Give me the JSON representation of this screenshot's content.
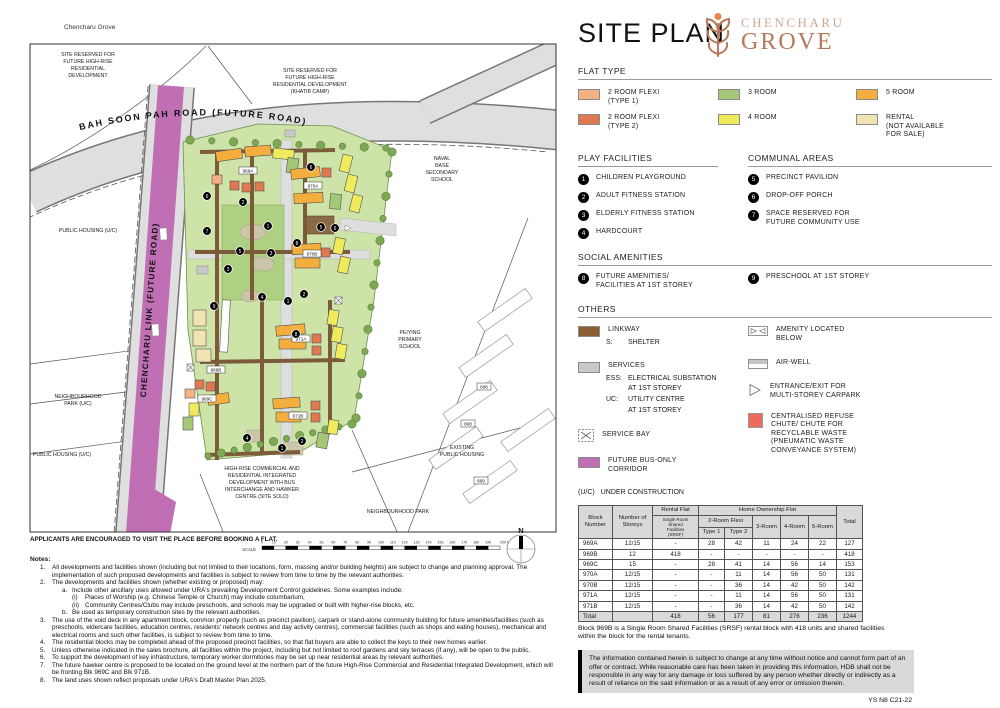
{
  "title": "SITE PLAN",
  "brand": {
    "top": "CHENCHARU",
    "bottom": "GROVE"
  },
  "colors": {
    "t1": "#F4B183",
    "t2": "#E07850",
    "r3": "#A5C878",
    "r4": "#F0EB5C",
    "r5": "#F3AE3E",
    "rental": "#F0E5B2",
    "linkway": "#8A5F34",
    "services": "#C8C8C8",
    "bus": "#C06FB5",
    "refuse": "#EC6A5C",
    "white": "#FFFFFF"
  },
  "legend": {
    "flat_type": {
      "heading": "FLAT TYPE",
      "items": [
        {
          "l1": "2 ROOM FLEXI",
          "l2": "(TYPE 1)"
        },
        {
          "l1": "3 ROOM"
        },
        {
          "l1": "5 ROOM"
        },
        {
          "l1": "2 ROOM FLEXI",
          "l2": "(TYPE 2)"
        },
        {
          "l1": "4 ROOM"
        },
        {
          "l1": "RENTAL",
          "l2": "(NOT AVAILABLE",
          "l3": "FOR SALE)"
        }
      ]
    },
    "play": {
      "heading": "PLAY FACILITIES",
      "items": [
        {
          "n": "1",
          "label": "CHILDREN PLAYGROUND"
        },
        {
          "n": "2",
          "label": "ADULT FITNESS STATION"
        },
        {
          "n": "3",
          "label": "ELDERLY FITNESS STATION"
        },
        {
          "n": "4",
          "label": "HARDCOURT"
        }
      ]
    },
    "communal": {
      "heading": "COMMUNAL AREAS",
      "items": [
        {
          "n": "5",
          "label": "PRECINCT PAVILION"
        },
        {
          "n": "6",
          "label": "DROP-OFF PORCH"
        },
        {
          "n": "7",
          "l1": "SPACE RESERVED FOR",
          "l2": "FUTURE COMMUNITY USE"
        }
      ]
    },
    "social": {
      "heading": "SOCIAL AMENITIES",
      "items": [
        {
          "n": "8",
          "l1": "FUTURE AMENITIES/",
          "l2": "FACILITIES AT 1ST STOREY"
        },
        {
          "n": "9",
          "l1": "PRESCHOOL AT 1ST STOREY"
        }
      ]
    },
    "others": {
      "heading": "OTHERS",
      "linkway": {
        "label": "LINKWAY",
        "sub_key": "S:",
        "sub_val": "SHELTER"
      },
      "services": {
        "label": "SERVICES",
        "rows": [
          {
            "k": "ESS:",
            "v": "ELECTRICAL SUBSTATION"
          },
          {
            "k": "",
            "v": "AT 1ST STOREY"
          },
          {
            "k": "UC:",
            "v": "UTILITY CENTRE"
          },
          {
            "k": "",
            "v": "AT 1ST STOREY"
          }
        ]
      },
      "service_bay": {
        "label": "SERVICE BAY"
      },
      "bus": {
        "label": "FUTURE BUS-ONLY CORRIDOR"
      },
      "amenity": {
        "l1": "AMENITY LOCATED",
        "l2": "BELOW"
      },
      "airwell": {
        "label": "AIR-WELL"
      },
      "carpark": {
        "l1": "ENTRANCE/EXIT FOR",
        "l2": "MULTI-STOREY CARPARK"
      },
      "refuse": {
        "l1": "CENTRALISED REFUSE",
        "l2": "CHUTE/ CHUTE FOR",
        "l3": "RECYCLABLE WASTE",
        "l4": "(PNEUMATIC WASTE",
        "l5": "CONVEYANCE SYSTEM)"
      }
    },
    "uc": {
      "k": "(U/C)",
      "v": "UNDER CONSTRUCTION"
    }
  },
  "table": {
    "headers": {
      "block": [
        "Block",
        "Number"
      ],
      "storeys": [
        "Number of",
        "Storeys"
      ],
      "rental": "Rental Flat",
      "srsf": [
        "Single Room",
        "Shared",
        "Facilities",
        "(SRSF)"
      ],
      "home": "Home Ownership Flat",
      "flexi": "2-Room Flexi",
      "t1": "Type 1",
      "t2": "Type 2",
      "r3": "3-Room",
      "r4": "4-Room",
      "r5": "5-Room",
      "total": "Total"
    },
    "rows": [
      [
        "969A",
        "12/15",
        "-",
        "28",
        "42",
        "11",
        "24",
        "22",
        "127"
      ],
      [
        "969B",
        "12",
        "418",
        "-",
        "-",
        "-",
        "-",
        "-",
        "418"
      ],
      [
        "969C",
        "15",
        "-",
        "28",
        "41",
        "14",
        "56",
        "14",
        "153"
      ],
      [
        "970A",
        "12/15",
        "-",
        "-",
        "11",
        "14",
        "56",
        "50",
        "131"
      ],
      [
        "970B",
        "12/15",
        "-",
        "-",
        "36",
        "14",
        "42",
        "50",
        "142"
      ],
      [
        "971A",
        "12/15",
        "-",
        "-",
        "11",
        "14",
        "56",
        "50",
        "131"
      ],
      [
        "971B",
        "12/15",
        "-",
        "-",
        "36",
        "14",
        "42",
        "50",
        "142"
      ]
    ],
    "total_row": [
      "Total",
      "",
      "418",
      "56",
      "177",
      "81",
      "276",
      "236",
      "1244"
    ],
    "footnote": "Block 969B is a Single Room Shared Facilities (SRSF) rental block with 418 units and shared facilities within the block for the rental tenants."
  },
  "disclaimer": "The information contained herein is subject to change at any time without notice and cannot form part of an offer or contract. While reasonable care has been taken in providing this information, HDB shall not be responsible in any way for any damage or loss suffered by any person whether directly or indirectly as a result of reliance on the said information or as a result of any error or omission therein.",
  "ref_code": "YS N8 C21-22",
  "notes": {
    "heading": "Notes:",
    "items": [
      {
        "n": "1.",
        "t": "All developments and facilities shown (including but not limited to their locations, form, massing and/or building heights) are subject to change and planning approval. The implementation of such proposed developments and facilities is subject to review from time to time by the relevant authorities."
      },
      {
        "n": "2.",
        "t": "The developments and facilities shown (whether existing or proposed) may:",
        "sub": [
          {
            "n": "a.",
            "t": "Include other ancillary uses allowed under URA's prevailing Development Control guidelines. Some examples include:",
            "sub": [
              {
                "n": "(i)",
                "t": "Places of Worship (e.g. Chinese Temple or Church) may include columbarium,"
              },
              {
                "n": "(ii)",
                "t": "Community Centres/Clubs may include preschools, and schools may be upgraded or built with higher-rise blocks, etc."
              }
            ]
          },
          {
            "n": "b.",
            "t": "Be used as temporary construction sites by the relevant authorities."
          }
        ]
      },
      {
        "n": "3.",
        "t": "The use of the void deck in any apartment block, common property (such as precinct pavilion), carpark or stand-alone community building for future amenities/facilities (such as preschools, eldercare facilities, education centres, residents' network centres and day activity centres), commercial facilities (such as shops and eating houses), mechanical and electrical rooms and such other facilities, is subject to review from time to time."
      },
      {
        "n": "4.",
        "t": "The residential blocks may be completed ahead of the proposed precinct facilities, so that flat buyers are able to collect the keys to their new homes earlier."
      },
      {
        "n": "5.",
        "t": "Unless otherwise indicated in the sales brochure, all facilities within the project, including but not limited to roof gardens and sky terraces (if any), will be open to the public."
      },
      {
        "n": "6.",
        "t": "To support the development of key infrastructure, temporary worker dormitories may be set up near residential areas by relevant authorities."
      },
      {
        "n": "7.",
        "t": "The future hawker centre is proposed to be located on the ground level at the northern part of the future High-Rise Commercial and Residential Integrated Development, which will be fronting Blk 969C and Blk 971B."
      },
      {
        "n": "8.",
        "t": "The land uses shown reflect proposals under URA's Draft Master Plan 2025."
      }
    ]
  },
  "map": {
    "project_label": "Chencharu Grove",
    "caption": "APPLICANTS ARE ENCOURAGED TO VISIT THE PLACE BEFORE BOOKING A FLAT.",
    "north": "N",
    "scale": {
      "label": "SCALE",
      "unit": "Metres",
      "ticks": [
        "0",
        "10",
        "20",
        "30",
        "40",
        "50",
        "60",
        "70",
        "80",
        "90",
        "100",
        "110",
        "120",
        "130",
        "140",
        "150",
        "160",
        "170",
        "180",
        "190",
        "200"
      ]
    },
    "labels": {
      "site_reserved_nw": [
        "SITE RESERVED FOR",
        "FUTURE HIGH-RISE",
        "RESIDENTIAL",
        "DEVELOPMENT"
      ],
      "site_reserved_ne": [
        "SITE RESERVED FOR",
        "FUTURE HIGH-RISE",
        "RESIDENTIAL DEVELOPMENT",
        "(KHATIB CAMP)"
      ],
      "bah_soon_pah": "BAH SOON PAH ROAD (FUTURE ROAD)",
      "chencharu_link": "CHENCHARU LINK (FUTURE ROAD)",
      "public_housing_uc_1": "PUBLIC HOUSING (U/C)",
      "public_housing_uc_2": "PUBLIC HOUSING (U/C)",
      "neighbourhood_park_uc": [
        "NEIGHBOURHOOD",
        "PARK (U/C)"
      ],
      "naval_base": [
        "NAVAL",
        "BASE",
        "SECONDARY",
        "SCHOOL"
      ],
      "peiying": [
        "PEIYING",
        "PRIMARY",
        "SCHOOL"
      ],
      "existing_public_housing": [
        "EXISTING",
        "PUBLIC HOUSING"
      ],
      "neighbourhood_park": "NEIGHBOURHOOD PARK",
      "integrated_dev": [
        "HIGH-RISE COMMERCIAL AND",
        "RESIDENTIAL INTEGRATED",
        "DEVELOPMENT WITH BUS",
        "INTERCHANGE AND HAWKER",
        "CENTRE (SITE SOLD)"
      ]
    },
    "blocks": [
      {
        "x": 248,
        "y": 171,
        "t": "969A"
      },
      {
        "x": 216,
        "y": 370,
        "t": "969B"
      },
      {
        "x": 207,
        "y": 399,
        "t": "969C"
      },
      {
        "x": 313,
        "y": 186,
        "t": "970A"
      },
      {
        "x": 312,
        "y": 254,
        "t": "970B"
      },
      {
        "x": 301,
        "y": 339,
        "t": "971A"
      },
      {
        "x": 298,
        "y": 416,
        "t": "971B"
      }
    ],
    "existing_blocks": [
      {
        "x": 484,
        "y": 387,
        "t": "806"
      },
      {
        "x": 468,
        "y": 424,
        "t": "808"
      },
      {
        "x": 481,
        "y": 481,
        "t": "809"
      }
    ],
    "markers": [
      {
        "x": 207,
        "y": 196,
        "n": "6"
      },
      {
        "x": 243,
        "y": 202,
        "n": "2"
      },
      {
        "x": 207,
        "y": 231,
        "n": "7"
      },
      {
        "x": 240,
        "y": 251,
        "n": "5"
      },
      {
        "x": 268,
        "y": 226,
        "n": "1"
      },
      {
        "x": 271,
        "y": 253,
        "n": "3"
      },
      {
        "x": 228,
        "y": 269,
        "n": "3"
      },
      {
        "x": 262,
        "y": 297,
        "n": "4"
      },
      {
        "x": 288,
        "y": 301,
        "n": "1"
      },
      {
        "x": 304,
        "y": 294,
        "n": "2"
      },
      {
        "x": 311,
        "y": 167,
        "n": "6"
      },
      {
        "x": 321,
        "y": 227,
        "n": "5"
      },
      {
        "x": 335,
        "y": 228,
        "n": "6"
      },
      {
        "x": 297,
        "y": 243,
        "n": "8"
      },
      {
        "x": 296,
        "y": 334,
        "n": "8"
      },
      {
        "x": 214,
        "y": 306,
        "n": "9"
      },
      {
        "x": 247,
        "y": 438,
        "n": "4"
      },
      {
        "x": 282,
        "y": 448,
        "n": "1"
      },
      {
        "x": 302,
        "y": 441,
        "n": "2"
      }
    ],
    "buildings": [
      {
        "x": 216,
        "y": 150,
        "w": 26,
        "h": 10,
        "r": -8,
        "c": "r5"
      },
      {
        "x": 245,
        "y": 146,
        "w": 26,
        "h": 10,
        "r": -4,
        "c": "r5"
      },
      {
        "x": 273,
        "y": 149,
        "w": 21,
        "h": 10,
        "r": 6,
        "c": "r4"
      },
      {
        "x": 212,
        "y": 175,
        "w": 10,
        "h": 9,
        "r": 0,
        "c": "t1"
      },
      {
        "x": 230,
        "y": 181,
        "w": 9,
        "h": 9,
        "r": 0,
        "c": "t2"
      },
      {
        "x": 242,
        "y": 183,
        "w": 9,
        "h": 9,
        "r": 0,
        "c": "t2"
      },
      {
        "x": 255,
        "y": 182,
        "w": 9,
        "h": 9,
        "r": 0,
        "c": "t2"
      },
      {
        "x": 287,
        "y": 158,
        "w": 11,
        "h": 15,
        "r": 8,
        "c": "r3"
      },
      {
        "x": 291,
        "y": 168,
        "w": 29,
        "h": 10,
        "r": -6,
        "c": "r5"
      },
      {
        "x": 294,
        "y": 193,
        "w": 29,
        "h": 10,
        "r": -3,
        "c": "r5"
      },
      {
        "x": 322,
        "y": 168,
        "w": 9,
        "h": 9,
        "r": 0,
        "c": "t2"
      },
      {
        "x": 330,
        "y": 194,
        "w": 11,
        "h": 15,
        "r": 5,
        "c": "r3"
      },
      {
        "x": 341,
        "y": 155,
        "w": 10,
        "h": 17,
        "r": 14,
        "c": "r4"
      },
      {
        "x": 346,
        "y": 175,
        "w": 10,
        "h": 17,
        "r": 14,
        "c": "r4"
      },
      {
        "x": 351,
        "y": 195,
        "w": 10,
        "h": 17,
        "r": 14,
        "c": "r4"
      },
      {
        "x": 292,
        "y": 244,
        "w": 29,
        "h": 10,
        "r": -3,
        "c": "r5"
      },
      {
        "x": 295,
        "y": 258,
        "w": 25,
        "h": 10,
        "r": 0,
        "c": "r5"
      },
      {
        "x": 321,
        "y": 248,
        "w": 9,
        "h": 9,
        "r": 0,
        "c": "t2"
      },
      {
        "x": 334,
        "y": 238,
        "w": 10,
        "h": 16,
        "r": 12,
        "c": "r4"
      },
      {
        "x": 339,
        "y": 257,
        "w": 10,
        "h": 16,
        "r": 12,
        "c": "r4"
      },
      {
        "x": 193,
        "y": 310,
        "w": 13,
        "h": 16,
        "r": 0,
        "c": "rental"
      },
      {
        "x": 193,
        "y": 330,
        "w": 13,
        "h": 16,
        "r": 0,
        "c": "rental"
      },
      {
        "x": 196,
        "y": 349,
        "w": 15,
        "h": 13,
        "r": 0,
        "c": "rental"
      },
      {
        "x": 221,
        "y": 300,
        "w": 8,
        "h": 52,
        "r": 3,
        "c": "white"
      },
      {
        "x": 276,
        "y": 325,
        "w": 29,
        "h": 10,
        "r": -5,
        "c": "r5"
      },
      {
        "x": 279,
        "y": 339,
        "w": 27,
        "h": 10,
        "r": 0,
        "c": "r5"
      },
      {
        "x": 312,
        "y": 334,
        "w": 9,
        "h": 9,
        "r": 0,
        "c": "t2"
      },
      {
        "x": 312,
        "y": 346,
        "w": 9,
        "h": 9,
        "r": 0,
        "c": "t2"
      },
      {
        "x": 328,
        "y": 310,
        "w": 10,
        "h": 15,
        "r": 10,
        "c": "r4"
      },
      {
        "x": 332,
        "y": 327,
        "w": 10,
        "h": 15,
        "r": 10,
        "c": "r4"
      },
      {
        "x": 336,
        "y": 344,
        "w": 10,
        "h": 15,
        "r": 10,
        "c": "r4"
      },
      {
        "x": 273,
        "y": 398,
        "w": 27,
        "h": 10,
        "r": -4,
        "c": "r5"
      },
      {
        "x": 276,
        "y": 412,
        "w": 25,
        "h": 10,
        "r": 0,
        "c": "r5"
      },
      {
        "x": 311,
        "y": 401,
        "w": 9,
        "h": 9,
        "r": 0,
        "c": "t2"
      },
      {
        "x": 311,
        "y": 413,
        "w": 9,
        "h": 9,
        "r": 0,
        "c": "t2"
      },
      {
        "x": 328,
        "y": 420,
        "w": 10,
        "h": 14,
        "r": 8,
        "c": "r4"
      },
      {
        "x": 317,
        "y": 433,
        "w": 11,
        "h": 15,
        "r": 10,
        "c": "r3"
      },
      {
        "x": 195,
        "y": 380,
        "w": 9,
        "h": 9,
        "r": 0,
        "c": "t2"
      },
      {
        "x": 206,
        "y": 382,
        "w": 9,
        "h": 9,
        "r": 0,
        "c": "t2"
      },
      {
        "x": 185,
        "y": 389,
        "w": 10,
        "h": 9,
        "r": 0,
        "c": "t1"
      },
      {
        "x": 208,
        "y": 394,
        "w": 21,
        "h": 10,
        "r": -8,
        "c": "r5"
      },
      {
        "x": 189,
        "y": 403,
        "w": 10,
        "h": 13,
        "r": 0,
        "c": "r4"
      },
      {
        "x": 183,
        "y": 417,
        "w": 10,
        "h": 13,
        "r": 0,
        "c": "r3"
      }
    ]
  }
}
